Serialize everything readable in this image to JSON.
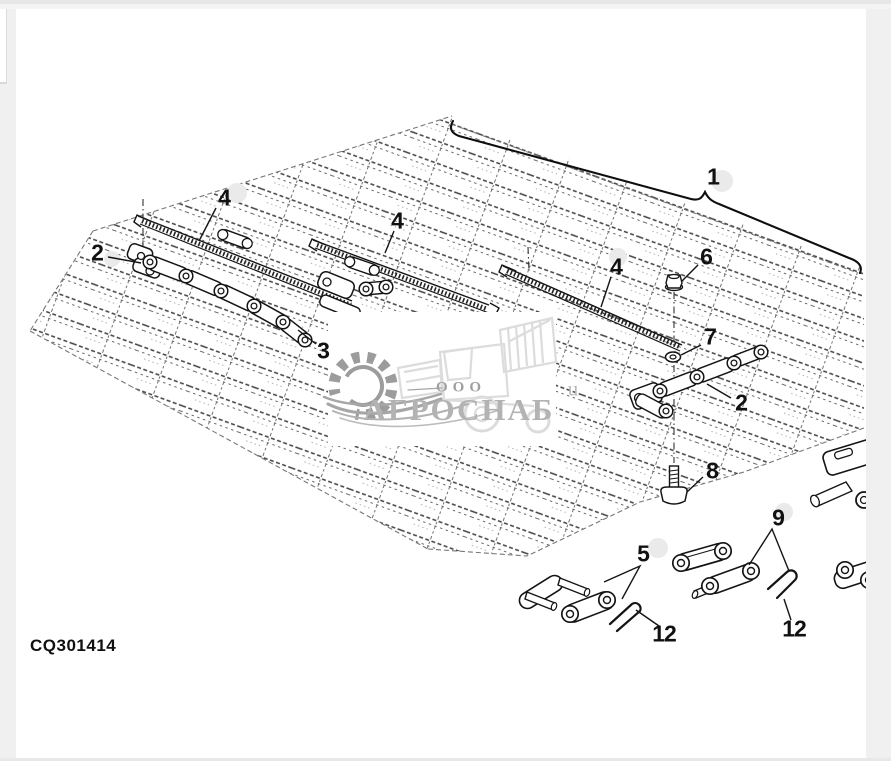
{
  "figure": {
    "part_code": "CQ301414",
    "callouts": [
      {
        "id": "1",
        "text": "1"
      },
      {
        "id": "2-left",
        "text": "2"
      },
      {
        "id": "4-left",
        "text": "4"
      },
      {
        "id": "4-middle",
        "text": "4"
      },
      {
        "id": "3",
        "text": "3"
      },
      {
        "id": "4-right",
        "text": "4"
      },
      {
        "id": "6",
        "text": "6"
      },
      {
        "id": "7",
        "text": "7"
      },
      {
        "id": "2-right",
        "text": "2"
      },
      {
        "id": "8",
        "text": "8"
      },
      {
        "id": "9",
        "text": "9"
      },
      {
        "id": "5",
        "text": "5"
      },
      {
        "id": "12-left",
        "text": "12"
      },
      {
        "id": "12-right",
        "text": "12"
      }
    ]
  },
  "watermark": {
    "prefix": "ООО",
    "name": "АГРОСНАБ",
    "ghost_letter": "u"
  },
  "colors": {
    "line": "#141414",
    "sketch": "#4a4a4a",
    "margin": "#f0f0f0",
    "watermark_text": "#b3b3b3",
    "watermark_gear": "#9c9c9c"
  }
}
